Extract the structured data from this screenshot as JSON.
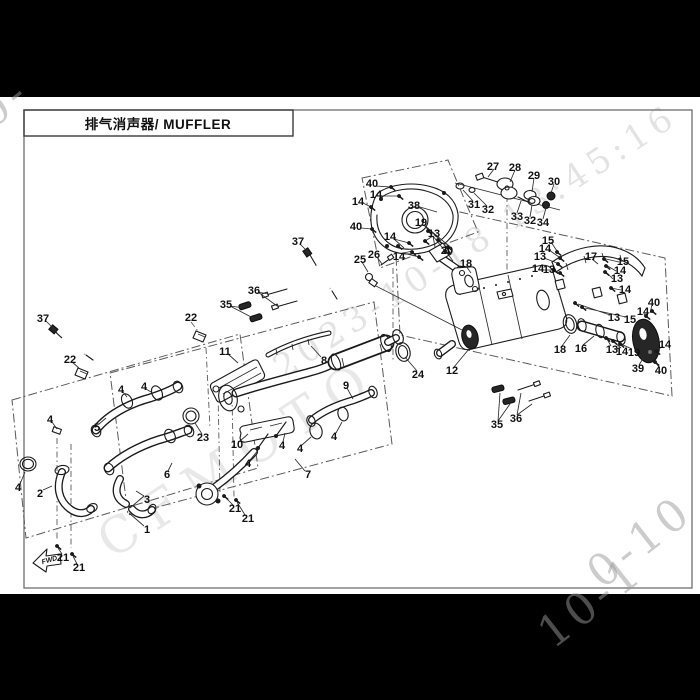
{
  "page": {
    "title": "排气消声器/ MUFFLER"
  },
  "watermarks": {
    "main": "2023-10-18 13:45:16",
    "brand": "CFMOTO",
    "corner_bottom_right_white": "0-10",
    "corner_bottom_right_black": "10-1",
    "corner_top_left": "0-"
  },
  "diagram": {
    "fwd_label": "FWD",
    "labels": [
      {
        "n": "40",
        "x": 372,
        "y": 183
      },
      {
        "n": "14",
        "x": 376,
        "y": 194
      },
      {
        "n": "14",
        "x": 358,
        "y": 201
      },
      {
        "n": "40",
        "x": 356,
        "y": 226
      },
      {
        "n": "38",
        "x": 414,
        "y": 205
      },
      {
        "n": "19",
        "x": 421,
        "y": 222
      },
      {
        "n": "13",
        "x": 434,
        "y": 233
      },
      {
        "n": "14",
        "x": 390,
        "y": 236
      },
      {
        "n": "14",
        "x": 399,
        "y": 256
      },
      {
        "n": "20",
        "x": 447,
        "y": 250
      },
      {
        "n": "18",
        "x": 466,
        "y": 263
      },
      {
        "n": "25",
        "x": 360,
        "y": 259
      },
      {
        "n": "26",
        "x": 374,
        "y": 254
      },
      {
        "n": "27",
        "x": 493,
        "y": 166
      },
      {
        "n": "28",
        "x": 515,
        "y": 167
      },
      {
        "n": "29",
        "x": 534,
        "y": 175
      },
      {
        "n": "30",
        "x": 554,
        "y": 181
      },
      {
        "n": "31",
        "x": 474,
        "y": 204
      },
      {
        "n": "32",
        "x": 488,
        "y": 209
      },
      {
        "n": "33",
        "x": 517,
        "y": 216
      },
      {
        "n": "32",
        "x": 530,
        "y": 220
      },
      {
        "n": "34",
        "x": 543,
        "y": 222
      },
      {
        "n": "15",
        "x": 548,
        "y": 240
      },
      {
        "n": "14",
        "x": 545,
        "y": 248
      },
      {
        "n": "13",
        "x": 540,
        "y": 256
      },
      {
        "n": "14",
        "x": 538,
        "y": 268
      },
      {
        "n": "13",
        "x": 549,
        "y": 269
      },
      {
        "n": "17",
        "x": 591,
        "y": 256
      },
      {
        "n": "15",
        "x": 623,
        "y": 261
      },
      {
        "n": "14",
        "x": 620,
        "y": 270
      },
      {
        "n": "13",
        "x": 617,
        "y": 278
      },
      {
        "n": "14",
        "x": 625,
        "y": 289
      },
      {
        "n": "13",
        "x": 614,
        "y": 317
      },
      {
        "n": "15",
        "x": 630,
        "y": 319
      },
      {
        "n": "40",
        "x": 654,
        "y": 302
      },
      {
        "n": "14",
        "x": 643,
        "y": 311
      },
      {
        "n": "14",
        "x": 665,
        "y": 344
      },
      {
        "n": "40",
        "x": 661,
        "y": 370
      },
      {
        "n": "39",
        "x": 638,
        "y": 368
      },
      {
        "n": "18",
        "x": 560,
        "y": 349
      },
      {
        "n": "16",
        "x": 581,
        "y": 348
      },
      {
        "n": "13",
        "x": 612,
        "y": 349
      },
      {
        "n": "14",
        "x": 622,
        "y": 351
      },
      {
        "n": "19",
        "x": 634,
        "y": 352
      },
      {
        "n": "12",
        "x": 452,
        "y": 370
      },
      {
        "n": "24",
        "x": 418,
        "y": 374
      },
      {
        "n": "37",
        "x": 298,
        "y": 241
      },
      {
        "n": "36",
        "x": 254,
        "y": 290
      },
      {
        "n": "35",
        "x": 226,
        "y": 304
      },
      {
        "n": "11",
        "x": 225,
        "y": 351
      },
      {
        "n": "8",
        "x": 324,
        "y": 360
      },
      {
        "n": "9",
        "x": 346,
        "y": 385
      },
      {
        "n": "23",
        "x": 203,
        "y": 437
      },
      {
        "n": "10",
        "x": 237,
        "y": 444
      },
      {
        "n": "4",
        "x": 248,
        "y": 463
      },
      {
        "n": "4",
        "x": 282,
        "y": 445
      },
      {
        "n": "4",
        "x": 300,
        "y": 448
      },
      {
        "n": "4",
        "x": 334,
        "y": 436
      },
      {
        "n": "7",
        "x": 308,
        "y": 474
      },
      {
        "n": "21",
        "x": 235,
        "y": 508
      },
      {
        "n": "21",
        "x": 248,
        "y": 518
      },
      {
        "n": "35",
        "x": 497,
        "y": 424
      },
      {
        "n": "36",
        "x": 516,
        "y": 418
      },
      {
        "n": "37",
        "x": 43,
        "y": 318
      },
      {
        "n": "22",
        "x": 191,
        "y": 317
      },
      {
        "n": "22",
        "x": 70,
        "y": 359
      },
      {
        "n": "4",
        "x": 121,
        "y": 389
      },
      {
        "n": "4",
        "x": 144,
        "y": 386
      },
      {
        "n": "5",
        "x": 97,
        "y": 427
      },
      {
        "n": "4",
        "x": 50,
        "y": 419
      },
      {
        "n": "6",
        "x": 167,
        "y": 474
      },
      {
        "n": "4",
        "x": 18,
        "y": 487
      },
      {
        "n": "2",
        "x": 40,
        "y": 493
      },
      {
        "n": "3",
        "x": 147,
        "y": 499
      },
      {
        "n": "1",
        "x": 147,
        "y": 529
      },
      {
        "n": "21",
        "x": 63,
        "y": 557
      },
      {
        "n": "21",
        "x": 79,
        "y": 567
      }
    ]
  }
}
